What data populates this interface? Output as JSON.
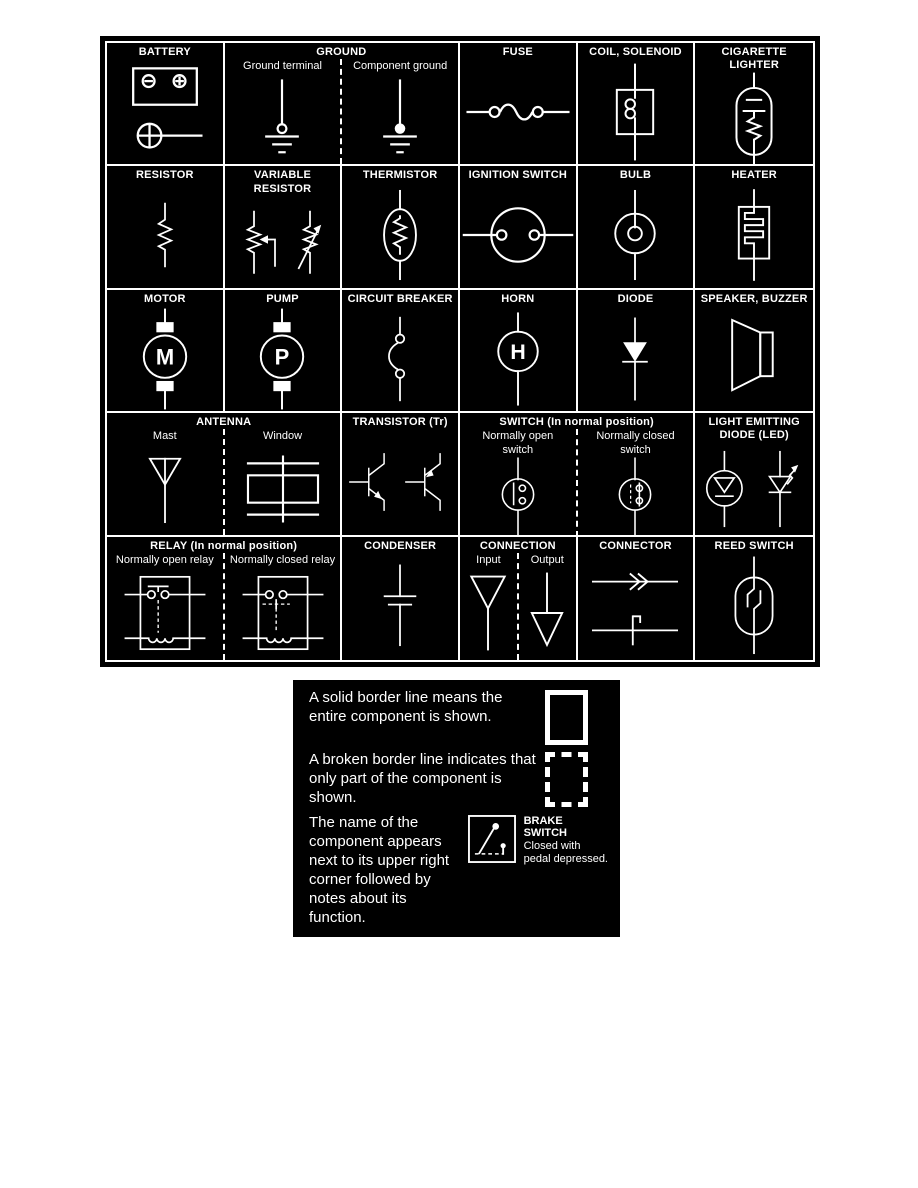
{
  "colors": {
    "panel_bg": "#000000",
    "line": "#ffffff",
    "page_bg": "#ffffff"
  },
  "symbol_table": {
    "letters": {
      "motor": "M",
      "pump": "P",
      "horn": "H"
    },
    "rows": [
      {
        "cells": [
          {
            "title": "BATTERY"
          },
          {
            "title": "GROUND",
            "sublabels": [
              "Ground terminal",
              "Component ground"
            ]
          },
          {
            "title": "FUSE"
          },
          {
            "title": "COIL, SOLENOID"
          },
          {
            "title": "CIGARETTE LIGHTER"
          }
        ]
      },
      {
        "cells": [
          {
            "title": "RESISTOR"
          },
          {
            "title": "VARIABLE RESISTOR"
          },
          {
            "title": "THERMISTOR"
          },
          {
            "title": "IGNITION SWITCH"
          },
          {
            "title": "BULB"
          },
          {
            "title": "HEATER"
          }
        ]
      },
      {
        "cells": [
          {
            "title": "MOTOR"
          },
          {
            "title": "PUMP"
          },
          {
            "title": "CIRCUIT BREAKER"
          },
          {
            "title": "HORN"
          },
          {
            "title": "DIODE"
          },
          {
            "title": "SPEAKER, BUZZER"
          }
        ]
      },
      {
        "cells": [
          {
            "title": "ANTENNA",
            "sublabels": [
              "Mast",
              "Window"
            ]
          },
          {
            "title": "TRANSISTOR (Tr)"
          },
          {
            "title": "SWITCH (In normal position)",
            "sublabels": [
              "Normally open switch",
              "Normally closed switch"
            ]
          },
          {
            "title": "LIGHT EMITTING DIODE (LED)"
          }
        ]
      },
      {
        "cells": [
          {
            "title": "RELAY (In normal position)",
            "sublabels": [
              "Normally open relay",
              "Normally closed relay"
            ]
          },
          {
            "title": "CONDENSER"
          },
          {
            "title": "CONNECTION",
            "sublabels": [
              "Input",
              "Output"
            ]
          },
          {
            "title": "CONNECTOR"
          },
          {
            "title": "REED SWITCH"
          }
        ]
      }
    ]
  },
  "notes_panel": {
    "items": [
      {
        "text": "A solid border line means the entire component is shown."
      },
      {
        "text": "A broken border line indicates that only part of the component is shown."
      },
      {
        "text": "The name of the component appears next to its upper right corner followed by notes about its function.",
        "symbol_label_line1": "BRAKE",
        "symbol_label_line2": "SWITCH",
        "symbol_note_line1": "Closed with",
        "symbol_note_line2": "pedal depressed."
      }
    ]
  }
}
